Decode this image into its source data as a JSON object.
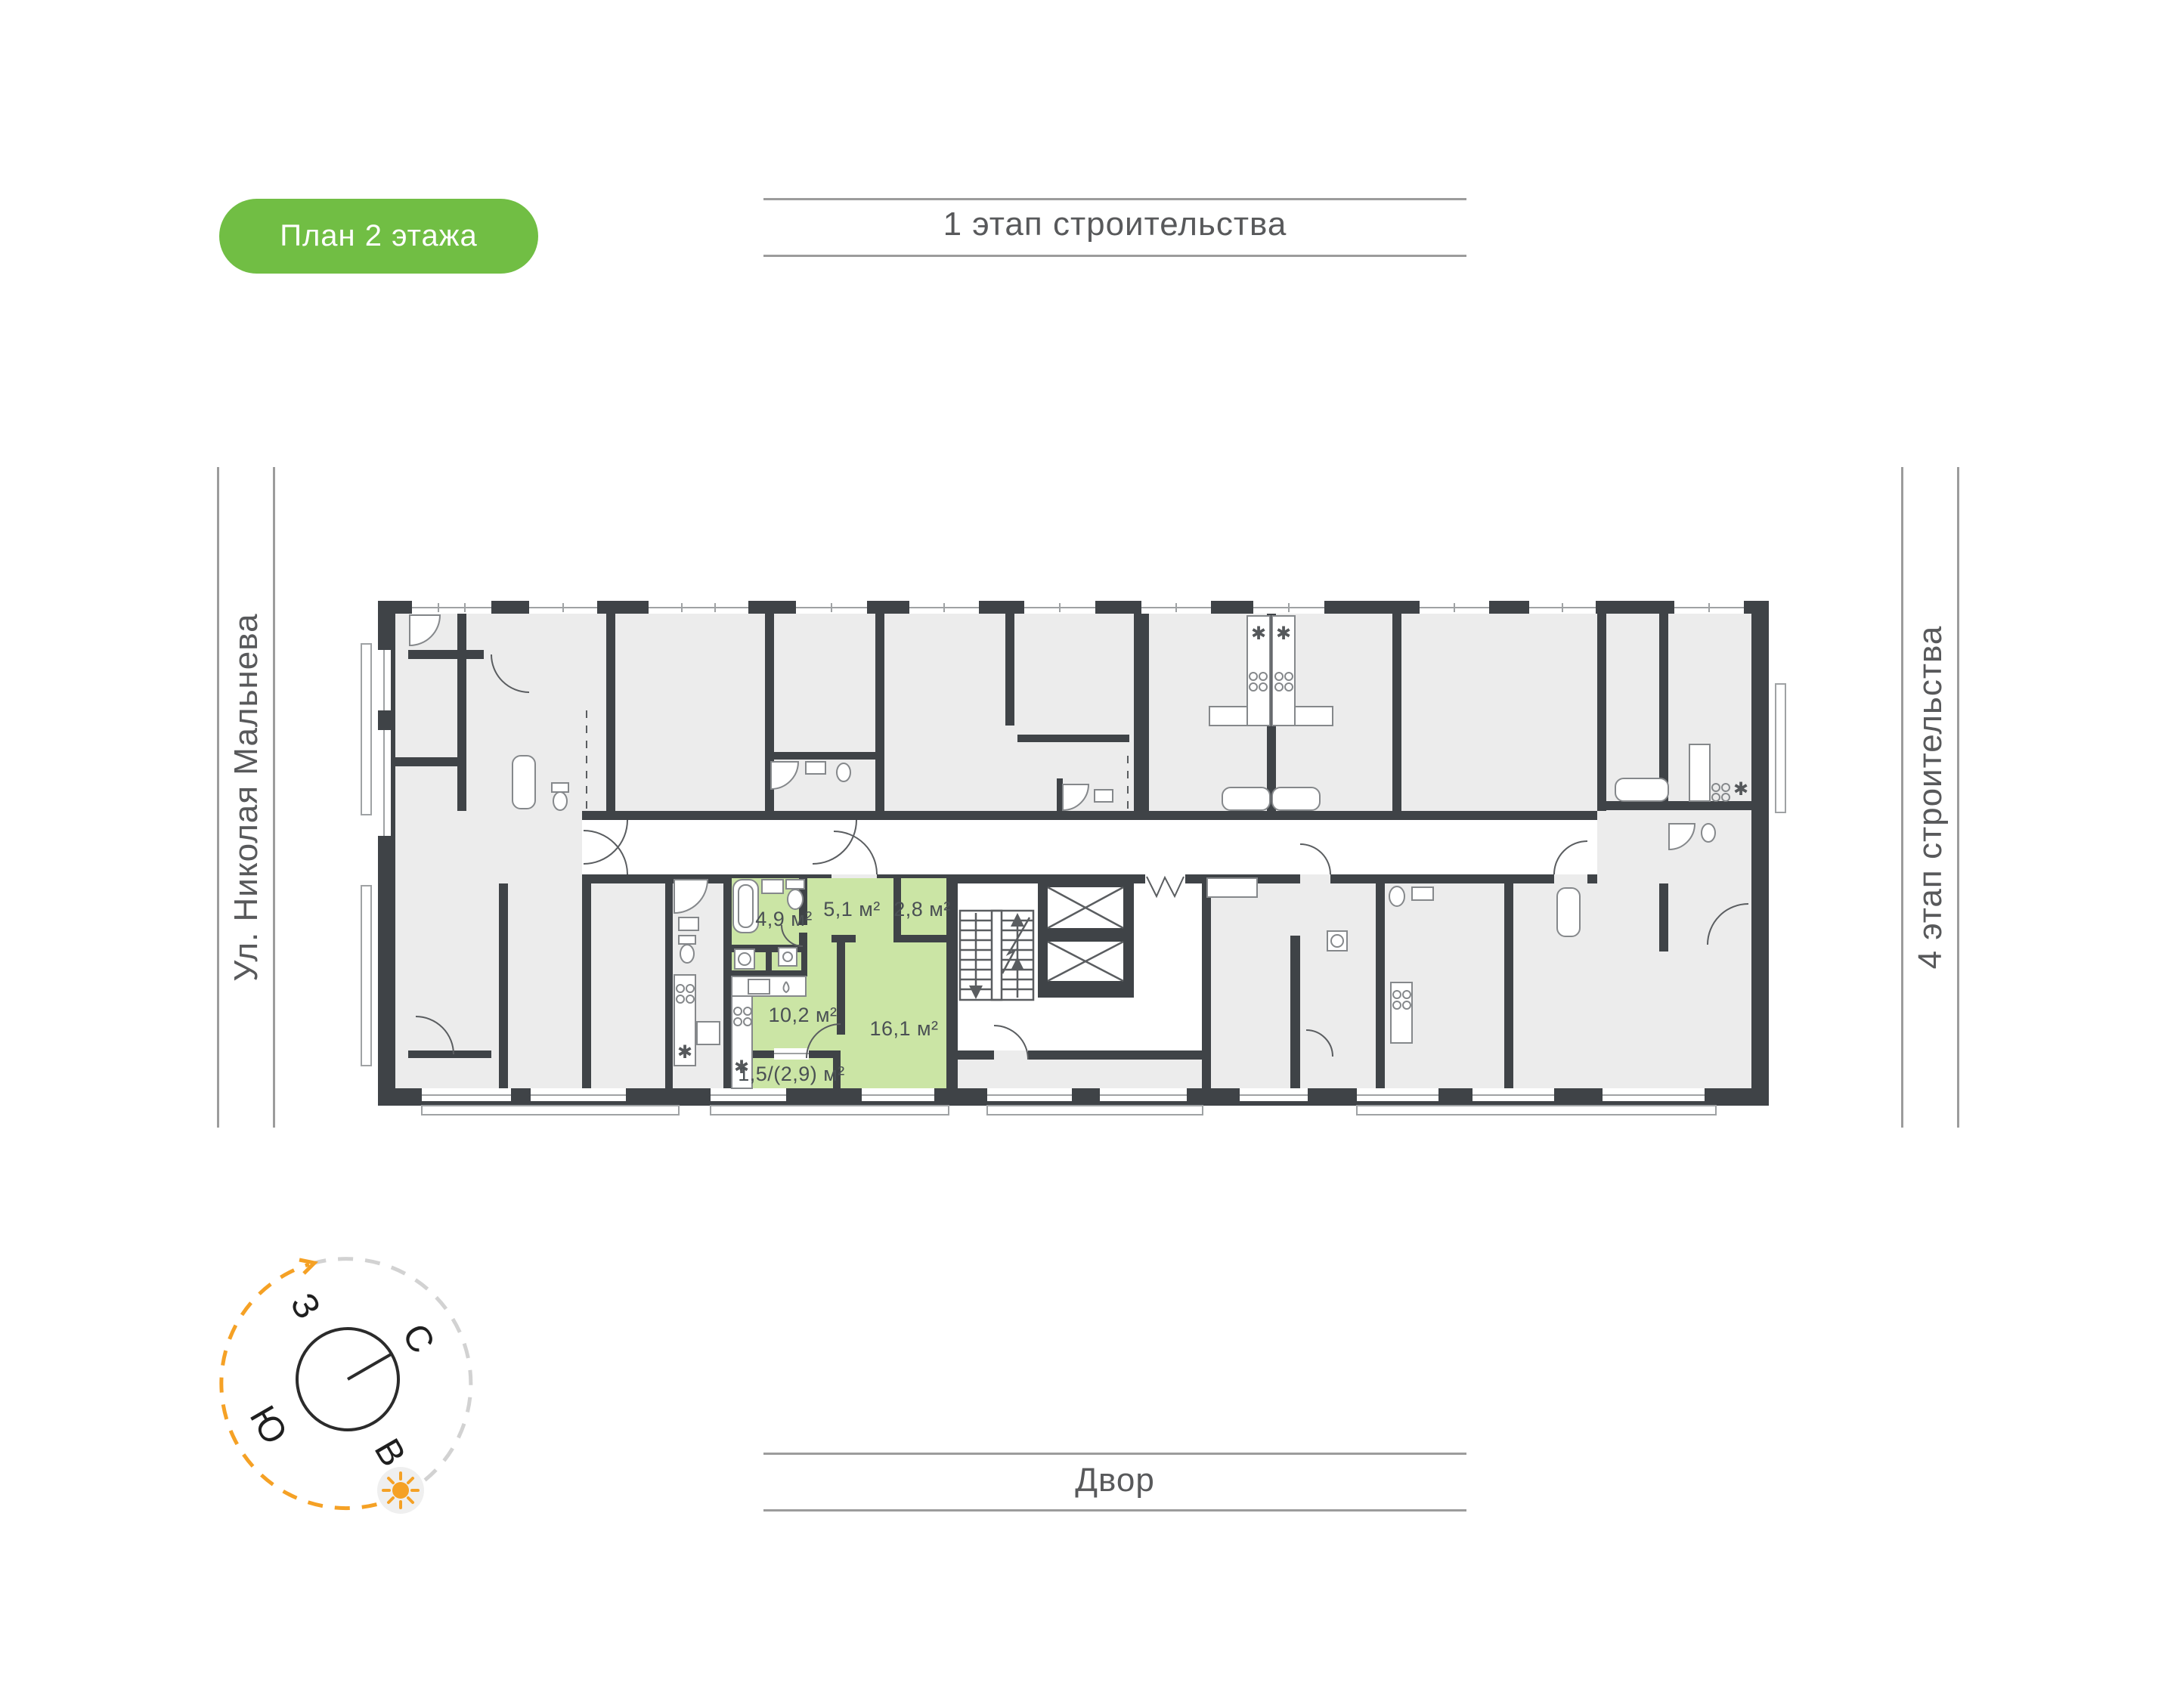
{
  "badge": {
    "label": "План 2 этажа"
  },
  "annotations": {
    "top_label": "1 этап строительства",
    "bottom_label": "Двор",
    "left_label": "Ул. Николая Мальнева",
    "right_label": "4 этап строительства"
  },
  "floor_plan": {
    "highlighted_apartment": {
      "rooms": [
        {
          "name": "bathroom",
          "area": "4,9 м²"
        },
        {
          "name": "hallway",
          "area": "5,1 м²"
        },
        {
          "name": "storage",
          "area": "2,8 м²"
        },
        {
          "name": "kitchen",
          "area": "10,2 м²"
        },
        {
          "name": "living-room",
          "area": "16,1 м²"
        },
        {
          "name": "balcony",
          "area": "1,5/(2,9) м²"
        }
      ]
    }
  },
  "compass": {
    "north": "С",
    "east": "В",
    "south": "Ю",
    "west": "З"
  },
  "colors": {
    "accent_green": "#71BE44",
    "apartment_highlight": "#CBE5A5",
    "wall": "#3F4347",
    "room_fill": "#ECECEC",
    "guide_line": "#9C9C9C",
    "text_gray": "#58595B",
    "sun_orange": "#F5A125"
  }
}
